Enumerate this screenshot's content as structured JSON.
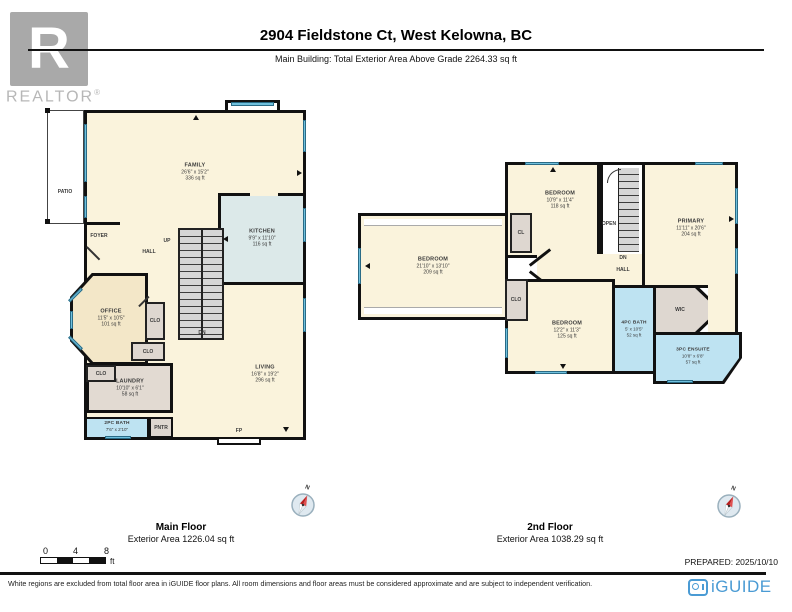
{
  "header": {
    "title": "2904 Fieldstone Ct, West Kelowna, BC",
    "subtitle": "Main Building: Total Exterior Area Above Grade 2264.33 sq ft",
    "realtor_logo": {
      "letter": "R",
      "wordmark": "REALTOR",
      "registered": "®"
    }
  },
  "floors": {
    "main": {
      "name": "Main Floor",
      "area": "Exterior Area 1226.04 sq ft",
      "rooms": {
        "family": {
          "label": "FAMILY",
          "dims": "26'6\" x 15'2\"",
          "area": "336 sq ft"
        },
        "kitchen": {
          "label": "KITCHEN",
          "dims": "9'9\" x 11'10\"",
          "area": "116 sq ft"
        },
        "living": {
          "label": "LIVING",
          "dims": "16'8\" x 19'2\"",
          "area": "296 sq ft"
        },
        "office": {
          "label": "OFFICE",
          "dims": "11'5\" x 10'5\"",
          "area": "101 sq ft"
        },
        "laundry": {
          "label": "LAUNDRY",
          "dims": "10'10\" x 6'1\"",
          "area": "58 sq ft"
        },
        "bath": {
          "label": "2PC BATH",
          "dims": "7'6\" x 2'10\""
        },
        "patio": {
          "label": "PATIO"
        },
        "foyer": {
          "label": "FOYER"
        },
        "hall": {
          "label": "HALL"
        },
        "up": {
          "label": "UP"
        },
        "dn": {
          "label": "DN"
        },
        "clo1": {
          "label": "CLO"
        },
        "clo2": {
          "label": "CLO"
        },
        "clo3": {
          "label": "CLO"
        },
        "pntr": {
          "label": "PNTR"
        },
        "fp": {
          "label": "FP"
        }
      }
    },
    "second": {
      "name": "2nd Floor",
      "area": "Exterior Area 1038.29 sq ft",
      "rooms": {
        "bedroom_w": {
          "label": "BEDROOM",
          "dims": "21'10\" x 13'10\"",
          "area": "209 sq ft"
        },
        "bedroom_n": {
          "label": "BEDROOM",
          "dims": "10'9\" x 11'4\"",
          "area": "118 sq ft"
        },
        "bedroom_s": {
          "label": "BEDROOM",
          "dims": "12'2\" x 11'3\"",
          "area": "125 sq ft"
        },
        "primary": {
          "label": "PRIMARY",
          "dims": "11'11\" x 20'6\"",
          "area": "204 sq ft"
        },
        "bath": {
          "label": "4PC BATH",
          "dims": "5' x 10'5\"",
          "area": "52 sq ft"
        },
        "ensuite": {
          "label": "3PC ENSUITE",
          "dims": "10'8\" x 6'8\"",
          "area": "57 sq ft"
        },
        "cl": {
          "label": "CL"
        },
        "clo": {
          "label": "CLO"
        },
        "wic": {
          "label": "WIC"
        },
        "hall": {
          "label": "HALL"
        },
        "open": {
          "label": "OPEN"
        },
        "dn": {
          "label": "DN"
        }
      }
    }
  },
  "compass": {
    "north_label": "N"
  },
  "scale_bar": {
    "ticks": [
      "0",
      "4",
      "8"
    ],
    "unit": "ft"
  },
  "footer": {
    "prepared": "PREPARED: 2025/10/10",
    "disclaimer": "White regions are excluded from total floor area in iGUIDE floor plans. All room dimensions and floor areas must be considered approximate and are subject to independent verification.",
    "brand": "iGUIDE"
  },
  "colors": {
    "room_cream": "#faf3dc",
    "room_tan": "#f3e7c8",
    "room_blue": "#bee3f2",
    "room_kitchen": "#dce9e9",
    "room_gray": "#ded7d0",
    "wall": "#111111",
    "window": "#6fc0dd",
    "brand_blue": "#4a9bd4"
  }
}
